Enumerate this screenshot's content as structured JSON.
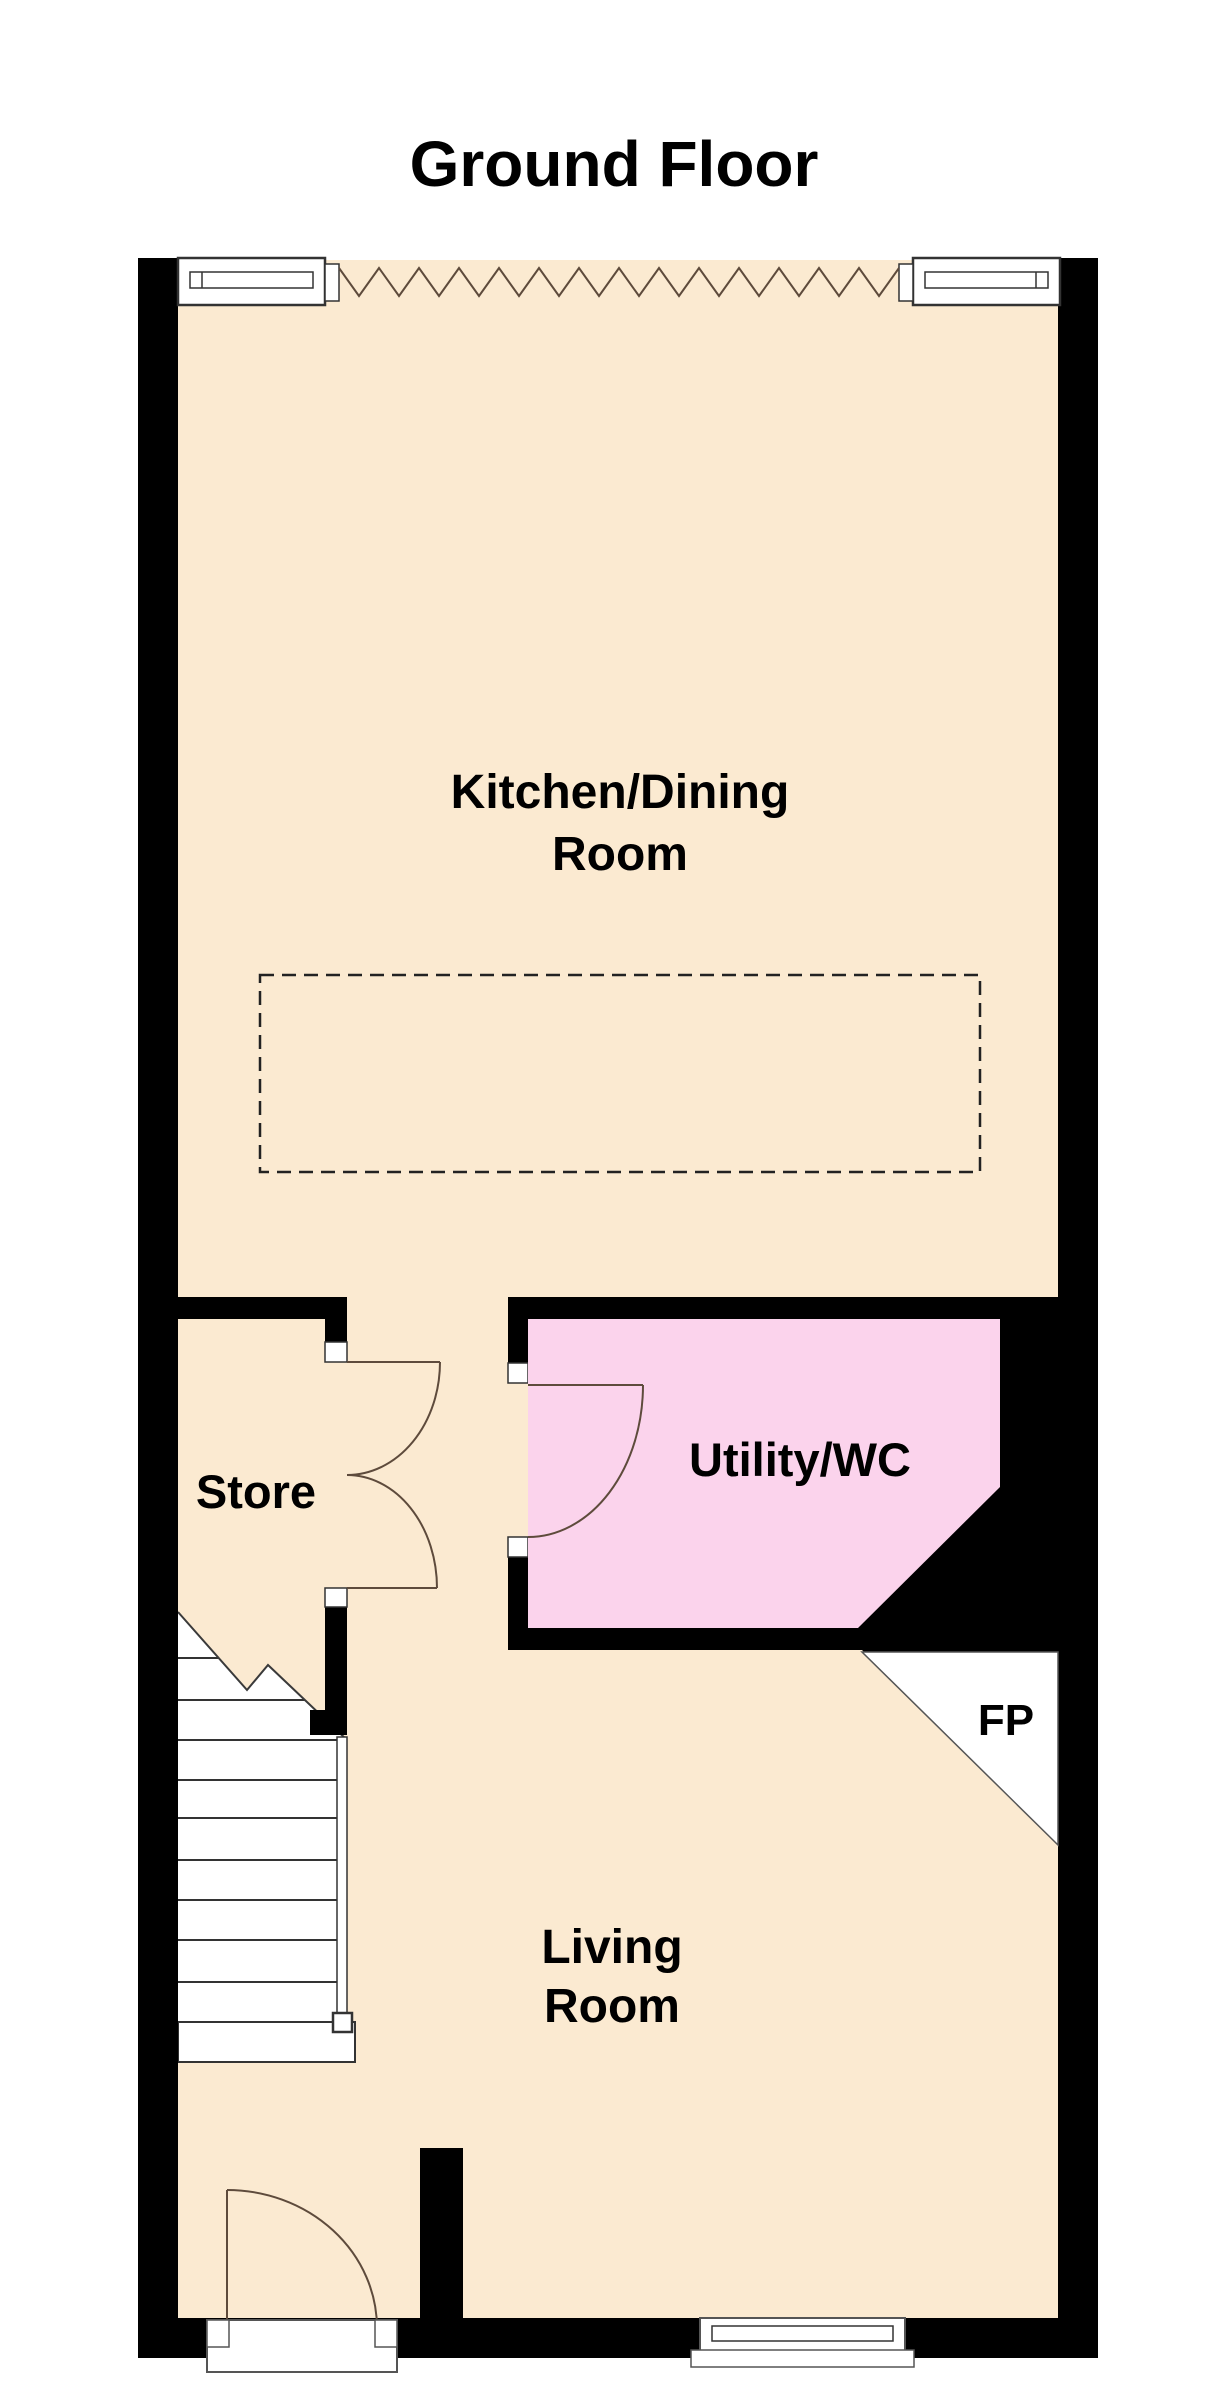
{
  "title": "Ground Floor",
  "rooms": {
    "kitchen_dining": {
      "label_line1": "Kitchen/Dining",
      "label_line2": "Room"
    },
    "store": {
      "label": "Store"
    },
    "utility_wc": {
      "label": "Utility/WC"
    },
    "living": {
      "label_line1": "Living",
      "label_line2": "Room"
    },
    "fireplace": {
      "label": "FP"
    }
  },
  "colors": {
    "floor_cream": "#FBEAD1",
    "floor_pink": "#FBD3EC",
    "wall_black": "#000000",
    "door_line": "#5E4B3C",
    "detail_line": "#333333",
    "frame_gray": "#555555"
  }
}
